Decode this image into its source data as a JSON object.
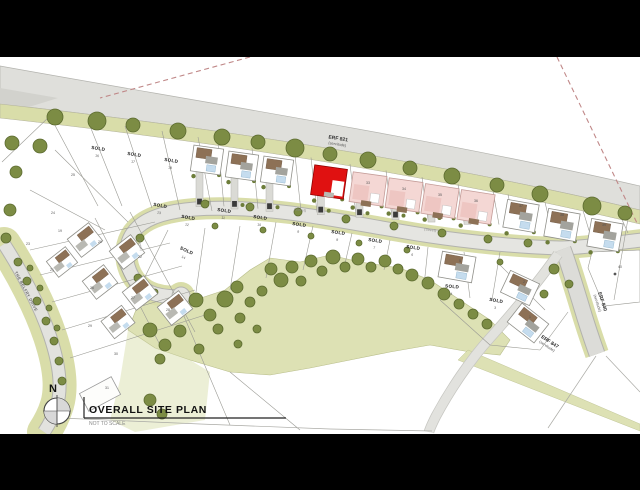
{
  "title_block": {
    "compass_letter": "N",
    "title": "OVERALL SITE PLAN",
    "subtitle": "NOT TO SCALE"
  },
  "road_labels": {
    "erf821": {
      "l1": "ERF 821",
      "l2": "(servitude)"
    },
    "erf840": {
      "l1": "ERF 840",
      "l2": "(servitude)"
    },
    "erf847": {
      "l1": "ERF 847",
      "l2": "(servitude)"
    },
    "belfry": "THE BELFRY DRIVE",
    "street": "(Street)"
  },
  "sold_text": "SOLD",
  "colors": {
    "highlight_red": "#e01111",
    "unit_pink": "#f4d7d4",
    "verge_green": "#d9dda9",
    "open_space_green": "#dde1b4",
    "tree_green": "#7c8c44",
    "tree_stroke": "#5c6b30",
    "road_gray": "#dfdfdb",
    "roof_brown": "#8d7156",
    "pool_blue": "#c5dcee",
    "letterbox_black": "#000000"
  },
  "street_label_positions": [
    [
      300,
      211,
      7
    ],
    [
      430,
      231,
      7
    ],
    [
      139,
      245,
      75
    ]
  ],
  "erf_positions": [
    {
      "key": "erf840",
      "x": 601,
      "y": 302,
      "rot": 72
    },
    {
      "key": "erf847",
      "x": 549,
      "y": 343,
      "rot": 33
    }
  ],
  "trees": [
    [
      55,
      117,
      8
    ],
    [
      97,
      121,
      9
    ],
    [
      133,
      125,
      7
    ],
    [
      178,
      131,
      8
    ],
    [
      222,
      137,
      8
    ],
    [
      258,
      142,
      7
    ],
    [
      295,
      148,
      9
    ],
    [
      330,
      154,
      7
    ],
    [
      368,
      160,
      8
    ],
    [
      410,
      168,
      7
    ],
    [
      452,
      176,
      8
    ],
    [
      497,
      185,
      7
    ],
    [
      540,
      194,
      8
    ],
    [
      592,
      206,
      9
    ],
    [
      625,
      213,
      7
    ],
    [
      12,
      143,
      7
    ],
    [
      16,
      172,
      6
    ],
    [
      40,
      146,
      7
    ],
    [
      10,
      210,
      6
    ],
    [
      6,
      238,
      5
    ],
    [
      18,
      262,
      4
    ],
    [
      27,
      281,
      4
    ],
    [
      37,
      301,
      4
    ],
    [
      46,
      321,
      4
    ],
    [
      54,
      341,
      4
    ],
    [
      59,
      361,
      4
    ],
    [
      62,
      381,
      4
    ],
    [
      30,
      268,
      3
    ],
    [
      40,
      288,
      3
    ],
    [
      49,
      308,
      3
    ],
    [
      57,
      328,
      3
    ],
    [
      205,
      204,
      4
    ],
    [
      250,
      207,
      4
    ],
    [
      298,
      212,
      4
    ],
    [
      346,
      219,
      4
    ],
    [
      394,
      226,
      4
    ],
    [
      442,
      233,
      4
    ],
    [
      488,
      239,
      4
    ],
    [
      528,
      243,
      4
    ],
    [
      600,
      238,
      4
    ],
    [
      215,
      226,
      3
    ],
    [
      263,
      230,
      3
    ],
    [
      311,
      236,
      3
    ],
    [
      359,
      243,
      3
    ],
    [
      407,
      250,
      3
    ],
    [
      455,
      257,
      3
    ],
    [
      500,
      262,
      3
    ],
    [
      140,
      238,
      4
    ],
    [
      131,
      258,
      4
    ],
    [
      138,
      278,
      4
    ],
    [
      155,
      292,
      3
    ],
    [
      171,
      303,
      3
    ],
    [
      150,
      330,
      7
    ],
    [
      165,
      345,
      6
    ],
    [
      180,
      331,
      6
    ],
    [
      196,
      300,
      7
    ],
    [
      210,
      315,
      6
    ],
    [
      225,
      299,
      8
    ],
    [
      237,
      287,
      6
    ],
    [
      250,
      302,
      5
    ],
    [
      262,
      291,
      5
    ],
    [
      271,
      269,
      6
    ],
    [
      281,
      280,
      7
    ],
    [
      292,
      267,
      6
    ],
    [
      301,
      281,
      5
    ],
    [
      311,
      261,
      6
    ],
    [
      322,
      271,
      5
    ],
    [
      333,
      257,
      7
    ],
    [
      345,
      267,
      5
    ],
    [
      358,
      259,
      6
    ],
    [
      371,
      267,
      5
    ],
    [
      385,
      261,
      6
    ],
    [
      398,
      269,
      5
    ],
    [
      412,
      275,
      6
    ],
    [
      428,
      283,
      6
    ],
    [
      444,
      294,
      6
    ],
    [
      459,
      304,
      5
    ],
    [
      473,
      314,
      5
    ],
    [
      487,
      324,
      5
    ],
    [
      160,
      359,
      5
    ],
    [
      199,
      349,
      5
    ],
    [
      238,
      344,
      4
    ],
    [
      218,
      329,
      5
    ],
    [
      257,
      329,
      4
    ],
    [
      150,
      400,
      6
    ],
    [
      162,
      414,
      5
    ],
    [
      240,
      318,
      5
    ],
    [
      554,
      269,
      5
    ],
    [
      569,
      284,
      4
    ],
    [
      544,
      294,
      4
    ]
  ],
  "houses": [
    {
      "cx": 207,
      "cy": 160,
      "rot": 8,
      "w": 30,
      "h": 26,
      "type": "white"
    },
    {
      "cx": 242,
      "cy": 166,
      "rot": 8,
      "w": 30,
      "h": 26,
      "type": "white"
    },
    {
      "cx": 277,
      "cy": 171,
      "rot": 8,
      "w": 30,
      "h": 26,
      "type": "white"
    },
    {
      "cx": 329,
      "cy": 182,
      "rot": 8,
      "w": 33,
      "h": 30,
      "type": "red"
    },
    {
      "cx": 368,
      "cy": 189,
      "rot": 8,
      "w": 34,
      "h": 30,
      "type": "pink"
    },
    {
      "cx": 404,
      "cy": 195,
      "rot": 8,
      "w": 34,
      "h": 30,
      "type": "pink"
    },
    {
      "cx": 440,
      "cy": 201,
      "rot": 9,
      "w": 34,
      "h": 30,
      "type": "pink"
    },
    {
      "cx": 476,
      "cy": 207,
      "rot": 9,
      "w": 34,
      "h": 30,
      "type": "pink"
    },
    {
      "cx": 521,
      "cy": 216,
      "rot": 10,
      "w": 32,
      "h": 28,
      "type": "white"
    },
    {
      "cx": 562,
      "cy": 225,
      "rot": 10,
      "w": 32,
      "h": 28,
      "type": "white"
    },
    {
      "cx": 605,
      "cy": 235,
      "rot": 10,
      "w": 32,
      "h": 28,
      "type": "white"
    },
    {
      "cx": 457,
      "cy": 267,
      "rot": 10,
      "w": 34,
      "h": 26,
      "type": "white"
    },
    {
      "cx": 520,
      "cy": 288,
      "rot": 25,
      "w": 32,
      "h": 24,
      "type": "white"
    },
    {
      "cx": 528,
      "cy": 323,
      "rot": 38,
      "w": 34,
      "h": 24,
      "type": "white"
    },
    {
      "cx": 85,
      "cy": 240,
      "rot": -38,
      "w": 27,
      "h": 23,
      "type": "cottage"
    },
    {
      "cx": 127,
      "cy": 252,
      "rot": -38,
      "w": 27,
      "h": 23,
      "type": "cottage"
    },
    {
      "cx": 100,
      "cy": 282,
      "rot": -38,
      "w": 27,
      "h": 23,
      "type": "cottage"
    },
    {
      "cx": 140,
      "cy": 293,
      "rot": -38,
      "w": 27,
      "h": 23,
      "type": "cottage"
    },
    {
      "cx": 175,
      "cy": 308,
      "rot": -38,
      "w": 27,
      "h": 23,
      "type": "cottage"
    },
    {
      "cx": 62,
      "cy": 262,
      "rot": -38,
      "w": 24,
      "h": 20,
      "type": "cottage"
    },
    {
      "cx": 118,
      "cy": 322,
      "rot": -38,
      "w": 26,
      "h": 22,
      "type": "cottage"
    },
    {
      "cx": 100,
      "cy": 394,
      "rot": -28,
      "w": 36,
      "h": 20,
      "type": "outline"
    }
  ],
  "sold_plots": [
    [
      98,
      150,
      9,
      "16"
    ],
    [
      134,
      156,
      9,
      "17"
    ],
    [
      171,
      162,
      9,
      "18"
    ],
    [
      160,
      207,
      10,
      "13"
    ],
    [
      186,
      252,
      25,
      "14"
    ],
    [
      188,
      219,
      10,
      "12"
    ],
    [
      224,
      212,
      8,
      "11"
    ],
    [
      260,
      219,
      8,
      "10"
    ],
    [
      299,
      226,
      8,
      "9"
    ],
    [
      338,
      234,
      8,
      "8"
    ],
    [
      375,
      242,
      8,
      "7"
    ],
    [
      413,
      249,
      8,
      "6"
    ],
    [
      452,
      288,
      5,
      "4"
    ],
    [
      496,
      302,
      10,
      "3"
    ]
  ],
  "plot_numbers": [
    [
      73,
      176,
      "25"
    ],
    [
      53,
      214,
      "24"
    ],
    [
      60,
      232,
      "19"
    ],
    [
      100,
      243,
      "20"
    ],
    [
      52,
      271,
      "21"
    ],
    [
      140,
      258,
      "22"
    ],
    [
      28,
      245,
      "23"
    ],
    [
      92,
      289,
      "26"
    ],
    [
      133,
      299,
      "27"
    ],
    [
      168,
      311,
      "28"
    ],
    [
      90,
      327,
      "29"
    ],
    [
      116,
      355,
      "30"
    ],
    [
      107,
      389,
      "31"
    ],
    [
      521,
      207,
      "37"
    ],
    [
      562,
      216,
      "38"
    ],
    [
      604,
      226,
      "39"
    ],
    [
      620,
      268,
      "40"
    ],
    [
      368,
      184,
      "33"
    ],
    [
      404,
      190,
      "34"
    ],
    [
      440,
      196,
      "35"
    ],
    [
      476,
      202,
      "36"
    ],
    [
      460,
      262,
      "5"
    ],
    [
      524,
      283,
      "2"
    ],
    [
      530,
      318,
      "1"
    ]
  ]
}
